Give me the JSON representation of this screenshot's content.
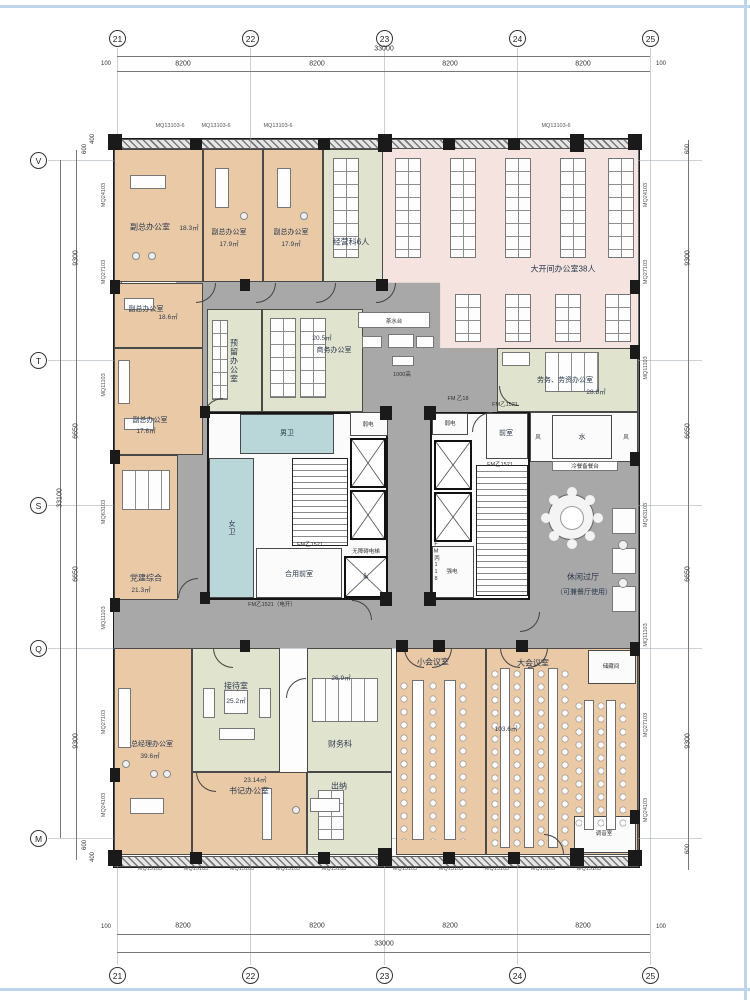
{
  "colors": {
    "office_tan": "#eac9a6",
    "open_office_pink": "#f4e3de",
    "support_green": "#e0e3ce",
    "wc_blue": "#b9d6d8",
    "corridor_gray": "#a8a8a8"
  },
  "axes": {
    "top_bubbles": [
      "21",
      "22",
      "23",
      "24",
      "25"
    ],
    "left_bubbles": [
      "V",
      "T",
      "S",
      "Q",
      "M"
    ],
    "dim_total_h": "33000",
    "dim_seg_h": "8200",
    "dim_end": "100",
    "dim_total_v": "33100",
    "dim_9300": "9300",
    "dim_6650": "6650",
    "dim_600": "600",
    "dim_400": "400"
  },
  "wall_tags": {
    "mq24": "MQ24103",
    "mq27": "MQ27103",
    "mq11": "MQ11103",
    "mq63": "MQ63103",
    "mq13": "MQ13103",
    "mq15": "MQ15103",
    "mq13_6": "MQ13103-6"
  },
  "rooms": {
    "vice1": {
      "label": "副总办公室",
      "area": "18.3㎡"
    },
    "vice2": {
      "label": "副总办公室",
      "area": "17.9㎡"
    },
    "vice3": {
      "label": "副总办公室",
      "area": "17.9㎡"
    },
    "ops": {
      "label": "经营科6人"
    },
    "open_office": {
      "label": "大开间办公室38人"
    },
    "vice4": {
      "label": "副总办公室",
      "area": "18.6㎡"
    },
    "vice5": {
      "label": "副总办公室",
      "area": "17.6㎡"
    },
    "party": {
      "label": "党建综合",
      "area": "21.3㎡"
    },
    "reserved": {
      "label": "预留办公室"
    },
    "business": {
      "label": "商务办公室",
      "area": "20.5㎡"
    },
    "labor": {
      "label": "劳务、劳资办公室",
      "area": "28.8㎡"
    },
    "lounge": {
      "label": "休闲过厅",
      "sub": "（可兼餐厅使用）"
    },
    "gm": {
      "label": "总经理办公室",
      "area": "39.6㎡"
    },
    "reception": {
      "label": "接待室",
      "area": "25.2㎡"
    },
    "secretary": {
      "label": "书记办公室",
      "area": "23.14㎡"
    },
    "finance": {
      "label": "财务科",
      "area": "26.9㎡"
    },
    "cashier": {
      "label": "出纳"
    },
    "small_meeting": {
      "label": "小会议室"
    },
    "large_meeting": {
      "label": "大会议室",
      "area": "103.6㎡"
    },
    "storage": {
      "label": "储藏间"
    },
    "av_room": {
      "label": "调音室"
    }
  },
  "core": {
    "male_wc": "男卫",
    "female_wc": "女卫",
    "weak_power": "弱电",
    "strong_power": "强电",
    "front_room": "前室",
    "shared_front_room": "合用前室",
    "accessible_elevator": "无障碍电梯",
    "wheelchair": "♿",
    "tea_station": "茶水台",
    "water": "水",
    "wind": "风",
    "buffet_counter": "冷餐备餐台",
    "corridor_note": "1000高"
  },
  "doors": {
    "fm1521": "FM乙1521",
    "fm1521_auto": "FM乙1521（电开）",
    "fm18": "FM 乙18",
    "fmb118": "FM丙118"
  }
}
